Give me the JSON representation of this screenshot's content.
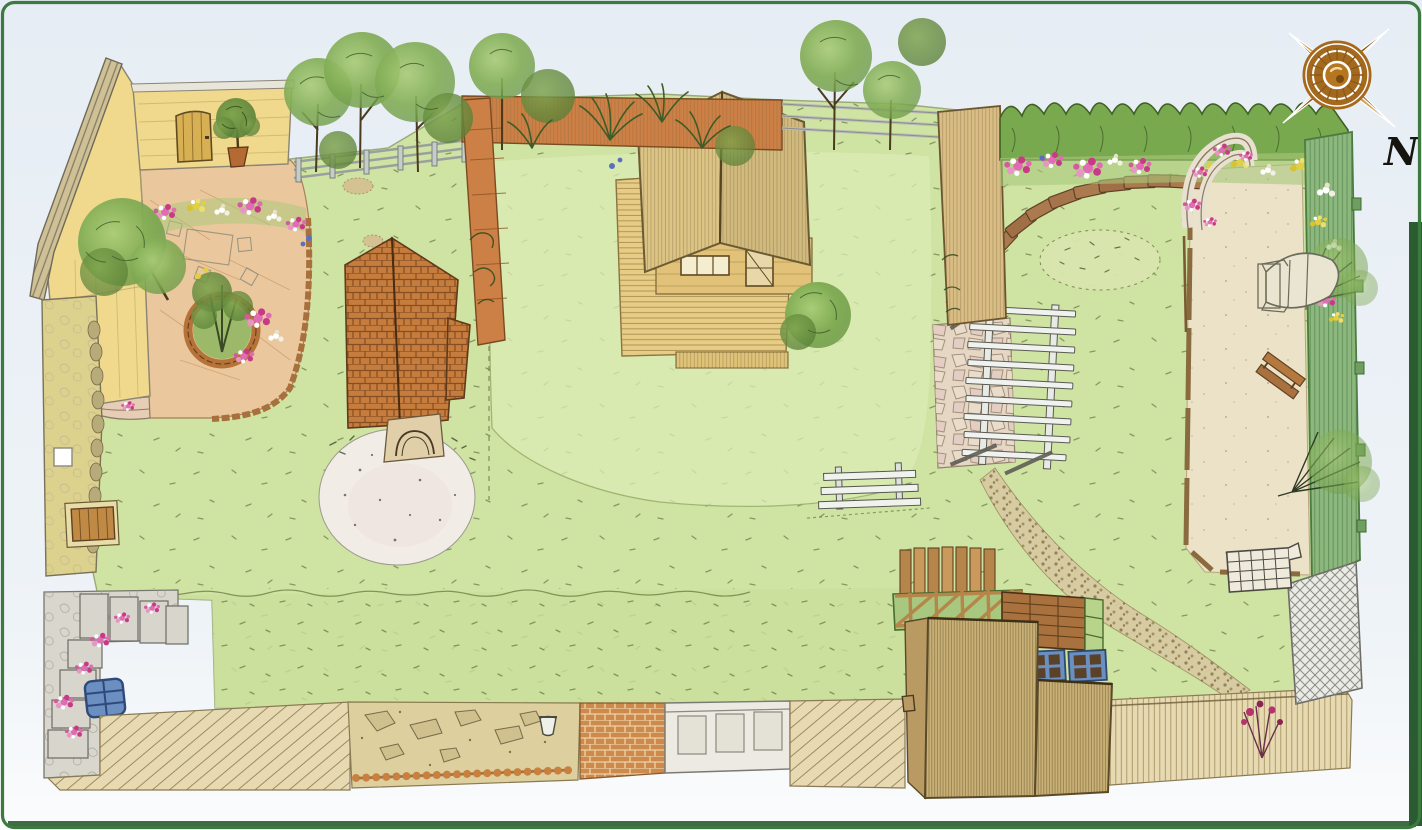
{
  "compass": {
    "label": "N"
  },
  "palette": {
    "bg": "#e9eff5",
    "lawn": "#cfe3a2",
    "lawn_light": "#dcecb6",
    "meadow": "#c9df9b",
    "sand": "#ece2c8",
    "terrace": "#eac79c",
    "house_roof": "#f0d98d",
    "cabin_wood": "#dcc485",
    "deck": "#e6cc85",
    "brick_roof": "#c67c3c",
    "fence_orange": "#cd8045",
    "hedge": "#79a94f",
    "fence_green": "#8cb77e",
    "stone_grey": "#d9d6cd",
    "wall_khaki": "#ddd28d",
    "boardwalk": "#e7dab2",
    "shed_wood": "#c9b176",
    "frame_blue": "#6b8fc0",
    "flower_pink": "#e06db4",
    "flower_magenta": "#c93a86",
    "flower_yellow": "#e3cf3f",
    "border_green": "#3c7a40",
    "border_dark": "#2b5c31",
    "compass_bronze": "#a5691e",
    "compass_light": "#d3a055"
  },
  "features": [
    "lawn",
    "meadow-strip",
    "house-roof",
    "house-door",
    "potted-tree",
    "terrace-paving",
    "flower-border",
    "circular-tree-bed",
    "terrace-steps",
    "garden-wall",
    "wall-door",
    "wall-window",
    "brick-roof-pavilion",
    "white-gravel-circle",
    "timber-cabin",
    "cabin-deck",
    "cabin-windows",
    "cabin-door",
    "post-and-rail-fence",
    "orange-board-fence",
    "boundary-trees",
    "ornamental-grasses",
    "tall-timber-screen",
    "clipped-hedge",
    "flower-bed",
    "stepping-stone-arc",
    "wildflower-oval",
    "pergola",
    "flagstone-patio",
    "garden-bench",
    "rose-arch",
    "sand-play-area",
    "rowing-boat",
    "play-benches",
    "sandpit-cover",
    "green-trellis-fence",
    "espalier-trees",
    "climbing-roses",
    "grey-trellis",
    "pebble-path",
    "stone-terrace-steps",
    "hydrangeas",
    "cold-frame-blue",
    "diagonal-decking",
    "rockery-bed",
    "rope-edging",
    "urn",
    "brick-path",
    "white-gate",
    "boardwalk",
    "wood-shed",
    "picket-screen",
    "raised-bed-lattice",
    "plank-wall",
    "cold-frames",
    "compass-rose"
  ]
}
